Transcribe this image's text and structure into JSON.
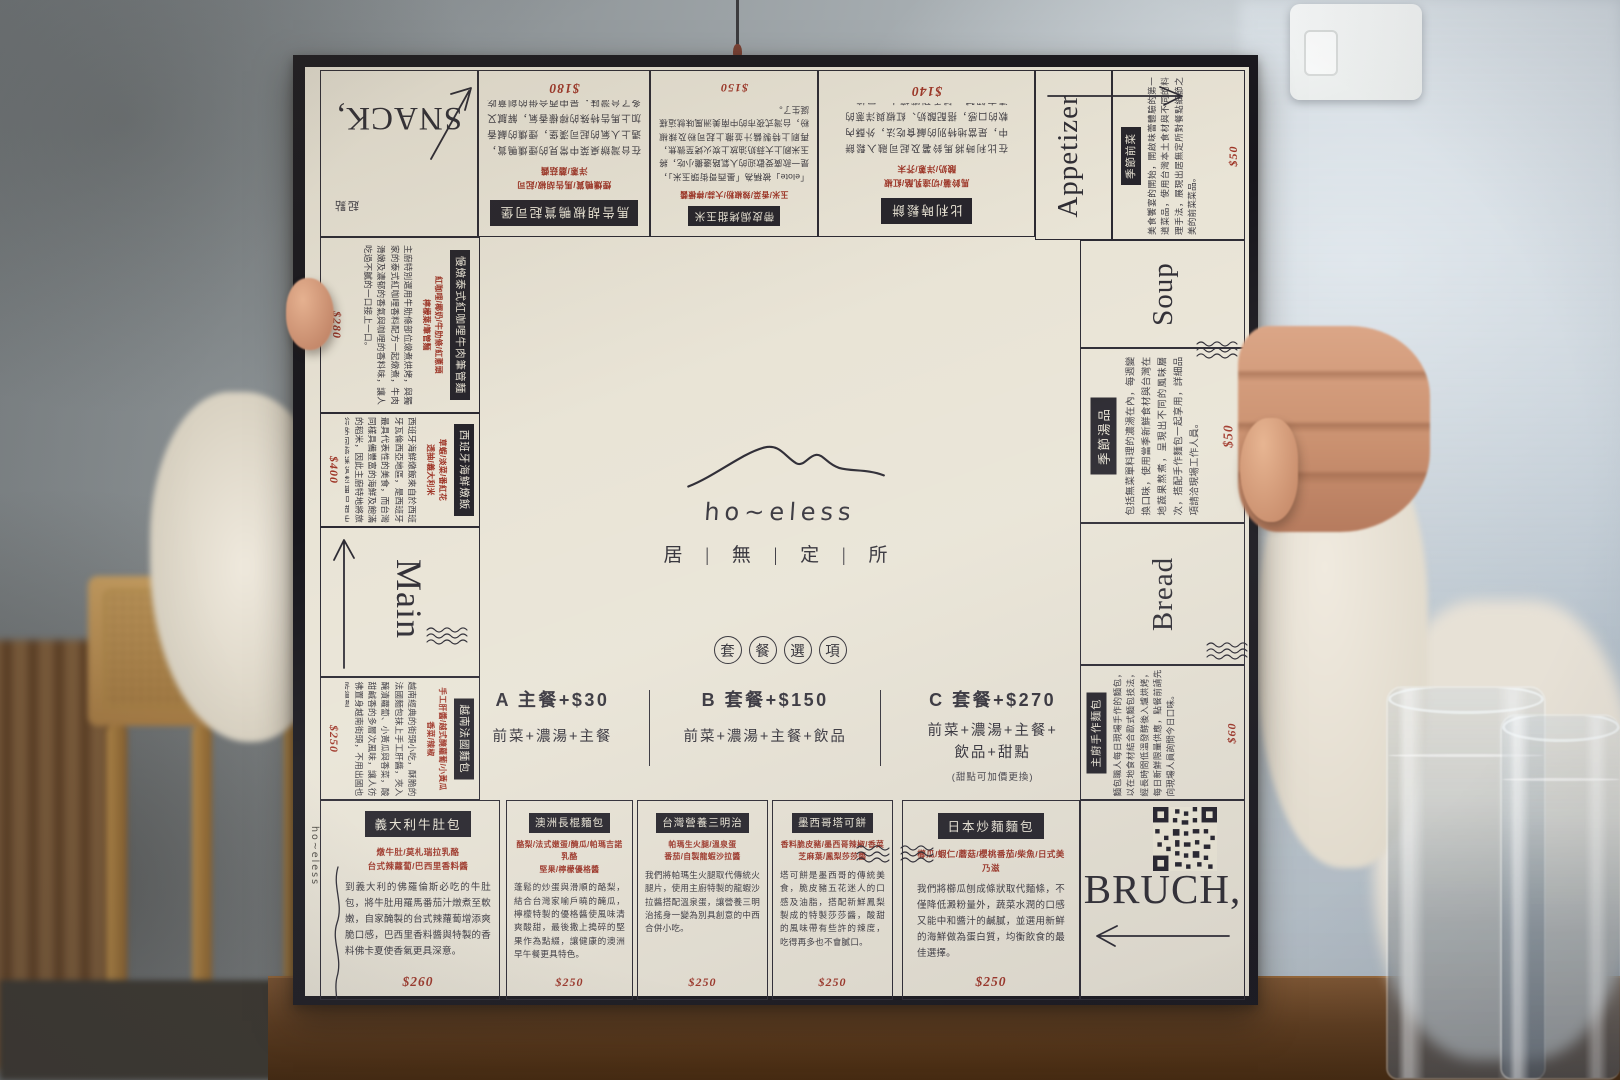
{
  "brand": {
    "logo_text": "ho~eless",
    "logo_cjk": "居 | 無 | 定 | 所"
  },
  "corners": {
    "snack": {
      "label": "SNACK,",
      "stamp": "起點"
    },
    "appetizer": {
      "label": "Appetizer"
    },
    "main": {
      "label": "Main"
    },
    "soup": {
      "label": "Soup"
    },
    "bread": {
      "label": "Bread"
    },
    "bruch": {
      "label": "BRUCH,"
    }
  },
  "set_menu": {
    "badge_chars": [
      "套",
      "餐",
      "選",
      "項"
    ],
    "options": [
      {
        "name": "A 主餐+$30",
        "detail": "前菜+濃湯+主餐"
      },
      {
        "name": "B 套餐+$150",
        "detail": "前菜+濃湯+主餐+飲品"
      },
      {
        "name": "C 套餐+$270",
        "detail": "前菜+濃湯+主餐+\n飲品+甜點",
        "note": "(甜點可加價更換)"
      }
    ]
  },
  "items": {
    "top": [
      {
        "title": "馬告胡椒鴨賞起司堡",
        "ingredients": "煙燻鴨賞/馬告胡椒/起司\n洋蔥/蘑菇醬",
        "desc": "在台灣辦桌菜中常見的煙燻鴨賞，遇上人氣的起司漢堡，煙燻的鹹香加上馬告特殊的檸檬香氣，解膩又多了台灣味，是中西合併的創意吃法，讓人驚豔的隱藏版美味。",
        "price": "$180"
      },
      {
        "title": "帶皮焗烤甜玉米",
        "ingredients": "玉米/香菜/辣椒粉/大蒜/檸檬醬",
        "desc": "「elote」被稱為「墨西哥街頭玉米」，是一款廣受歡迎的人氣路邊攤小吃，將玉米刷上大蒜奶油放上炭火烤至微焦，再刷上特製醬汁並撒上起司粉及辣椒粉，台灣式夜市的中南美洲風味就這樣誕生了。",
        "price": "$150"
      },
      {
        "title": "比利時鬆餅",
        "ingredients": "馬鈴薯/切達乳酪/紅椒\n酸奶/洋蔥/芥末",
        "desc": "在比利時將馬鈴薯及起司融入鬆餅中，是當地特別的鹹食吃法，外酥內軟的口感，搭配酸奶、紅椒與洋蔥的清爽解膩，鹹香涮嘴讓人一口接一口。",
        "price": "$140"
      }
    ],
    "left": [
      {
        "title": "慢燉泰式紅咖哩牛肉筆管麵",
        "ingredients": "紅咖哩/椰奶/牛肋條/紅蔥頭\n檸檬葉/筆管麵",
        "desc": "主廚特別選用牛肋條部位燉煮烘烤，與獨家的泰式紅咖哩香料配方一起燉煮，牛肉滑嫩及濃郁的香氣與咖哩的香料味，讓人吃過不膩的一口接上一口。",
        "price": "$280"
      },
      {
        "title": "西班牙海鮮燉飯",
        "ingredients": "草蝦/淡菜/番紅花\n透抽/義大利米",
        "desc": "西班牙海鮮燉飯來自於西班牙瓦倫西亞地區，是西班牙最具代表性的美食，而台灣同樣具備豐富的海鮮及飽滿的稻米，因此主廚特地將旅行的回憶透過料理呈現出來。",
        "price": "$400"
      },
      {
        "title": "越南法國麵包",
        "ingredients": "手工肝醬/越式醃蘿蔔/小黃瓜\n香菜/辣椒",
        "desc": "越南經典的街頭小吃，酥脆的法國麵包抹上手工肝醬，夾入醃漬蘿蔔、小黃瓜與香菜，酸甜鹹香的多層次風味，讓人彷彿置身越南街頭，不用出國也吃得到。",
        "price": "$250"
      }
    ],
    "right": [
      {
        "title": "季節前菜",
        "desc": "美食饗宴的開始，開啟味蕾體驗的第一道菜品，使用台灣本土食材與不同的料理手法，展現出居無定所對餐點細節之美的前菜菜品。",
        "price": "$50"
      },
      {
        "title": "季節湯品",
        "desc": "包括無菜單料理的濃湯在內，每週變換口味，使用當季新鮮食材與台灣在地蔬果熬煮，呈現出不同的風味層次，搭配手作麵包一起享用，詳細品項請洽現場工作人員。",
        "price": "$50"
      },
      {
        "title": "主廚手作麵包",
        "desc": "麵包職人每日現場手作的麵包，以在地食材結合歐式麵包技法，經長時間低溫發酵後入爐烘烤，每日新鮮限量供應，點餐前請先向現場人員詢問今日口味。",
        "price": "$60"
      }
    ],
    "bottom": [
      {
        "title": "義大利牛肚包",
        "ingredients": "燉牛肚/莫札瑞拉乳酪\n台式辣蘿蔔/巴西里香料醬",
        "desc": "到義大利的佛羅倫斯必吃的牛肚包，將牛肚用羅馬番茄汁燉煮至軟嫩，自家醃製的台式辣蘿蔔增添爽脆口感，巴西里香料醬與特製的香料佛卡夏使香氣更具深意。",
        "price": "$260"
      },
      {
        "title": "澳洲長棍麵包",
        "ingredients": "酪梨/法式嫩蛋/醃瓜/帕瑪吉諾乳酪\n堅果/檸檬優格醬",
        "desc": "蓬鬆的炒蛋與滑順的酪梨，結合台灣家喻戶曉的醃瓜，檸檬特製的優格醬使風味清爽酸甜，最後撒上搗碎的堅果作為點綴，讓健康的澳洲早午餐更具特色。",
        "price": "$250"
      },
      {
        "title": "台灣營養三明治",
        "ingredients": "帕瑪生火腿/溫泉蛋\n番茄/自製龍蝦沙拉醬",
        "desc": "我們將帕瑪生火腿取代傳統火腿片，使用主廚特製的龍蝦沙拉醬搭配溫泉蛋，讓營養三明治搖身一變為別具創意的中西合併小吃。",
        "price": "$250"
      },
      {
        "title": "墨西哥塔可餅",
        "ingredients": "香料脆皮豬/墨西哥辣椒/香菜\n芝麻葉/鳳梨莎莎醬",
        "desc": "塔可餅是墨西哥的傳統美食，脆皮豬五花迷人的口感及油脂，搭配新鮮鳳梨製成的特製莎莎醬，酸甜的風味帶有些許的辣度，吃得再多也不會膩口。",
        "price": "$250"
      },
      {
        "title": "日本炒麵麵包",
        "ingredients": "櫛瓜/蝦仁/蘑菇/櫻桃番茄/柴魚/日式美乃滋",
        "desc": "我們將櫛瓜刨成條狀取代麵條，不僅降低澱粉量外，蔬菜水潤的口感又能中和醬汁的鹹膩，並選用新鮮的海鮮做為蛋白質，均衡飲食的最佳選擇。",
        "price": "$250"
      }
    ]
  }
}
